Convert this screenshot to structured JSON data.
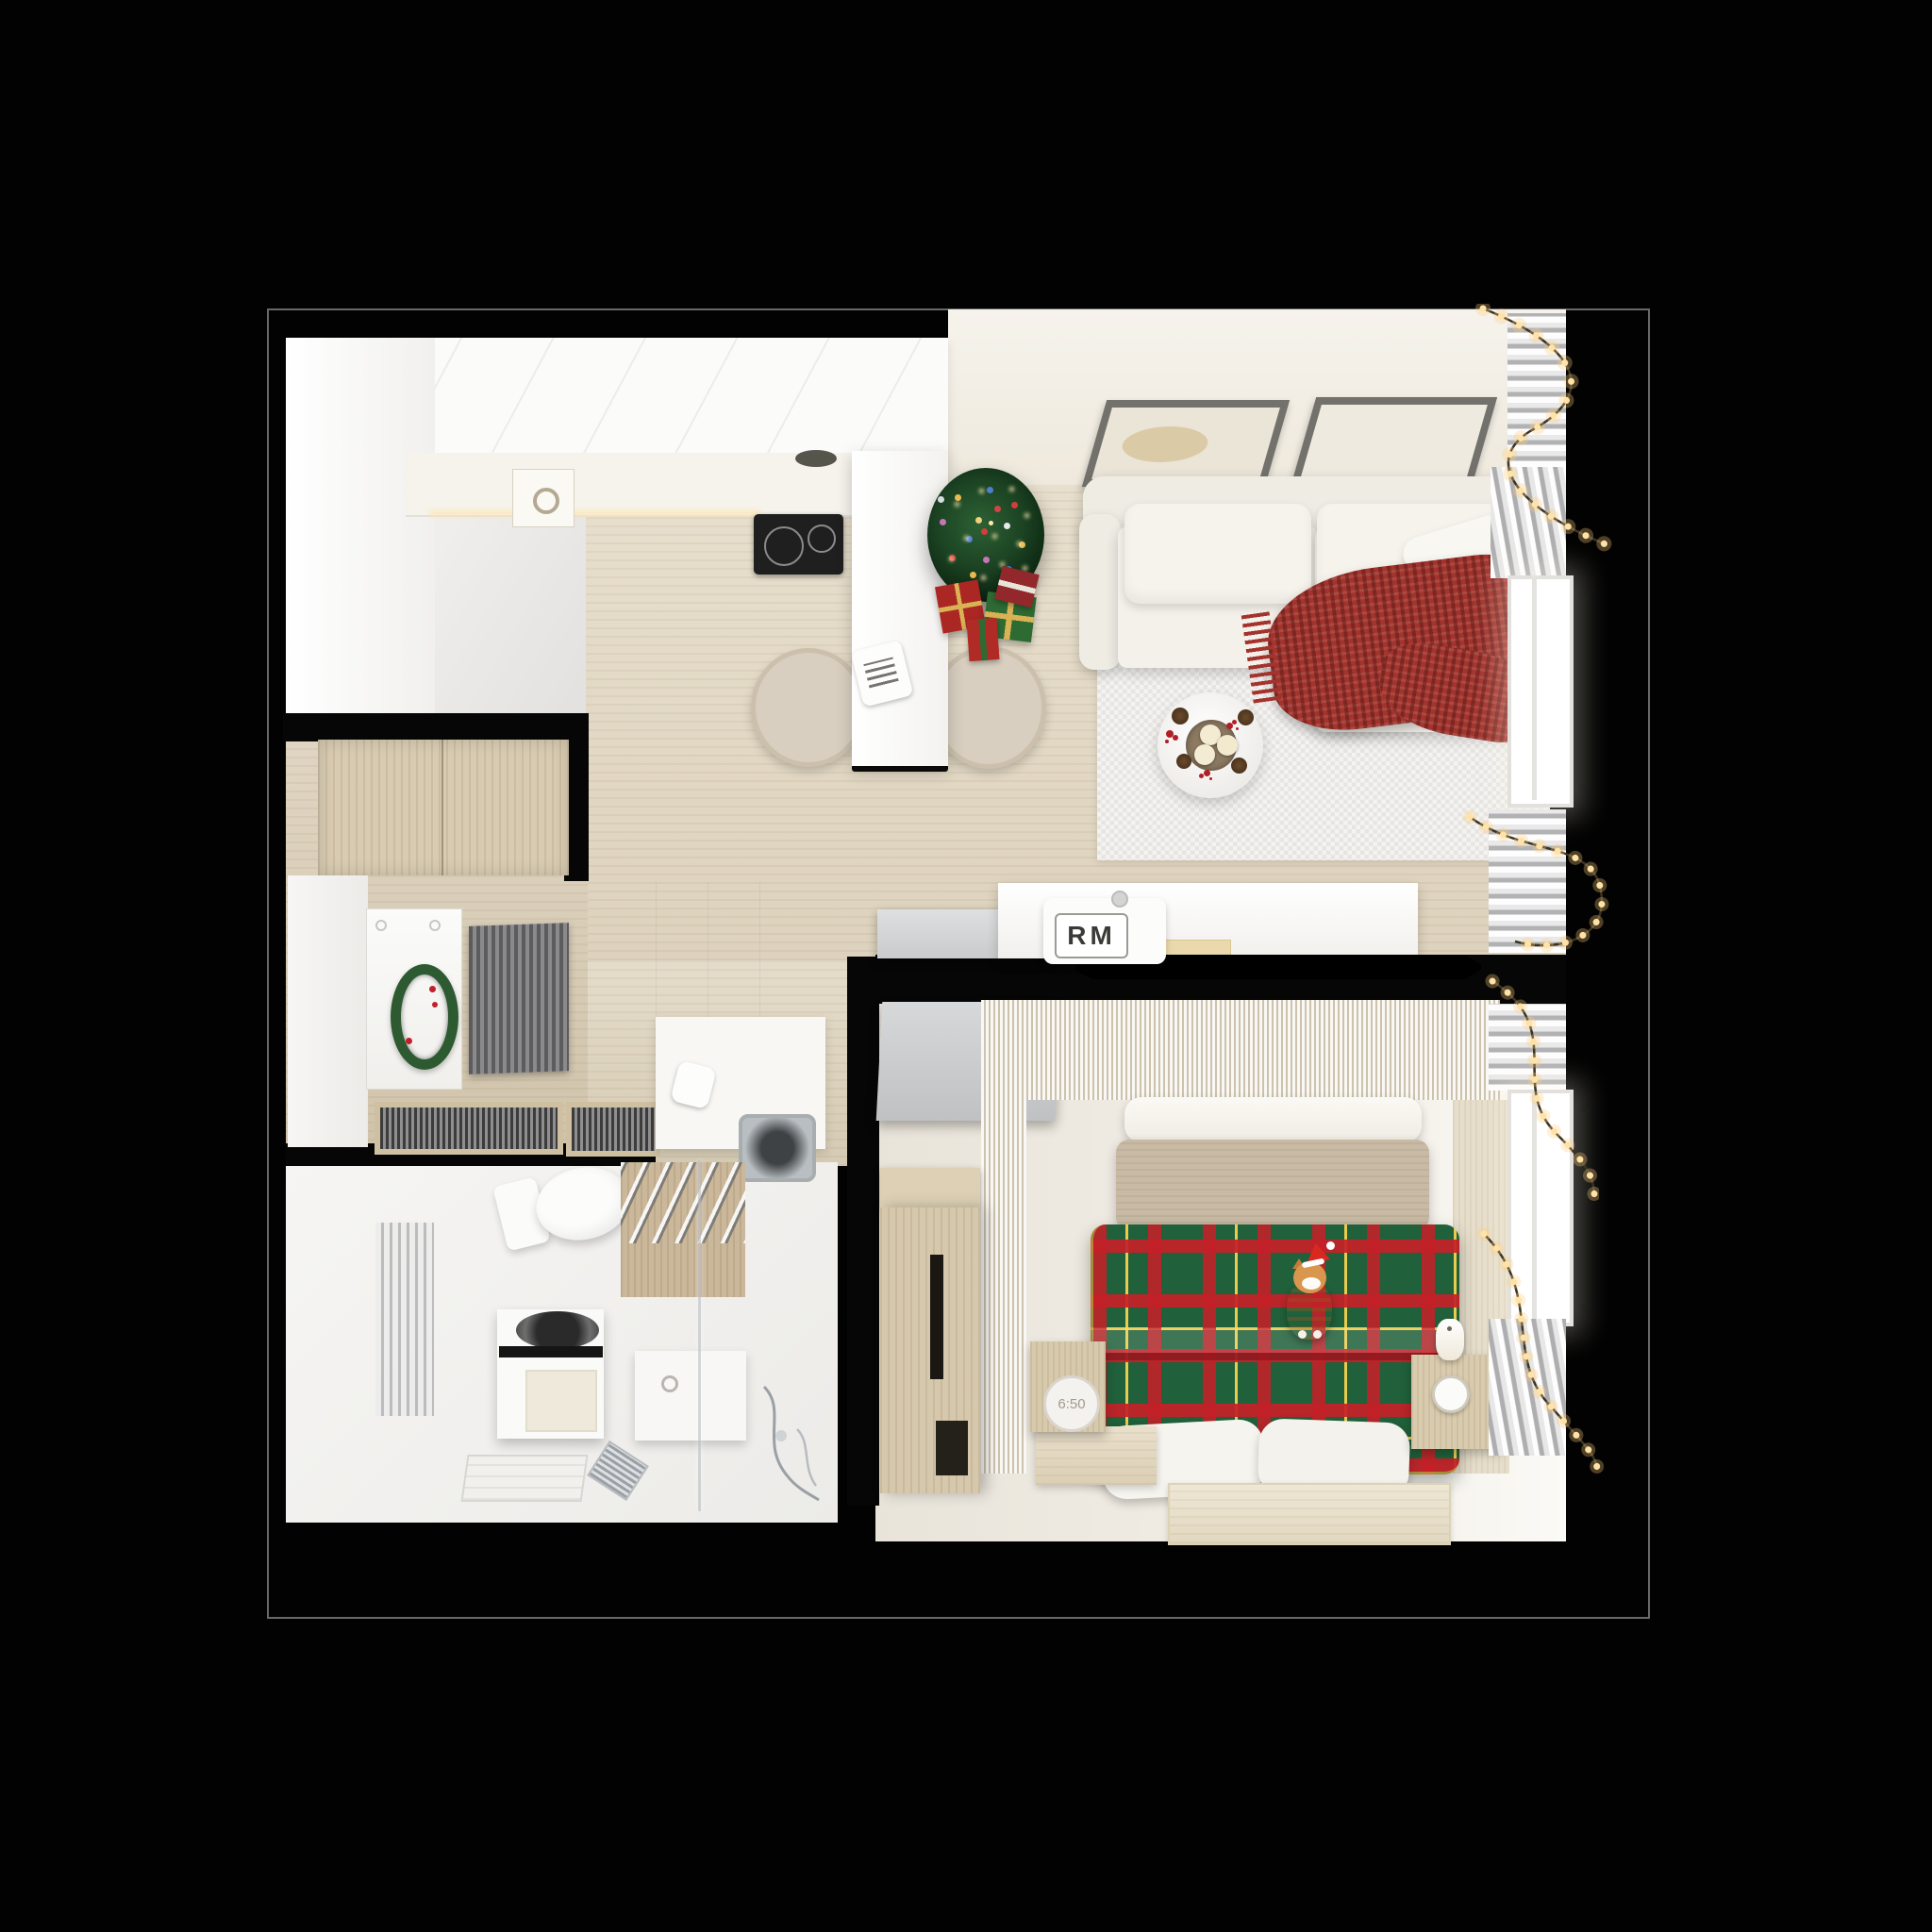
{
  "scene": {
    "type": "photoreal 3D top-down floor plan render",
    "setting": "small one-bedroom apartment decorated for Christmas, black background with thin frame line",
    "brand_badge": {
      "text": "RM"
    },
    "bedroom_clock": {
      "display": "6:50"
    },
    "palette": {
      "background": "#020202",
      "floor_wood": "#e4d9c3",
      "bath_floor": "#f3f2f0",
      "bedroom_floor": "#efeae1",
      "furniture_white": "#f5f3ee",
      "plaid_green": "#20603a",
      "plaid_red": "#c42028",
      "plaid_yellow": "#ffd750",
      "blanket_red": "#a2342d",
      "tree_green": "#1c4423",
      "garland_light": "#ffe2a6",
      "cat_orange": "#d4914e"
    },
    "rooms": [
      {
        "name": "Kitchen",
        "objects": [
          "white-upper-cabinets",
          "countertop",
          "sink",
          "cooktop-two-burners",
          "extractor-hood",
          "island-counter",
          "notebook",
          "two-bar-chairs",
          "under-cabinet-light"
        ]
      },
      {
        "name": "Living room",
        "objects": [
          "two-wall-art-frames",
          "white-corner-sofa",
          "throw-pillow",
          "red-knit-blanket",
          "checker-rug",
          "round-coffee-table",
          "three-candles",
          "pinecones",
          "red-berries",
          "christmas-tree-with-lights",
          "gift-boxes",
          "window-with-curtains",
          "string-lights-garland",
          "tv-console",
          "rm-speaker-badge",
          "flat-tv-on-wall",
          "gray-sliding-door"
        ]
      },
      {
        "name": "Entry hall",
        "objects": [
          "wood-sliding-closet",
          "front-door",
          "christmas-wreath-with-red-berries",
          "striped-doormat",
          "two-floor-grates",
          "vanity-counter",
          "square-sink",
          "faucet"
        ]
      },
      {
        "name": "Bathroom",
        "objects": [
          "wall-hung-toilet",
          "towel-radiator",
          "washing-machine-open-drum",
          "drawer-unit",
          "glass-shower-partition",
          "towel-panel-with-chrome-bars",
          "floor-drain",
          "bath-mat",
          "shower-fittings"
        ]
      },
      {
        "name": "Bedroom",
        "objects": [
          "slatted-headboard-wall",
          "white-headboard-shelf",
          "upholstered-headboard",
          "tartan-plaid-duvet",
          "orange-cat-with-santa-hat",
          "two-foot-pillows",
          "left-nightstand-with-clock",
          "wood-platform",
          "right-nightstand-with-candle",
          "tall-wood-wardrobe",
          "beige-rug",
          "window-with-curtains",
          "string-lights-garlands"
        ]
      }
    ]
  }
}
